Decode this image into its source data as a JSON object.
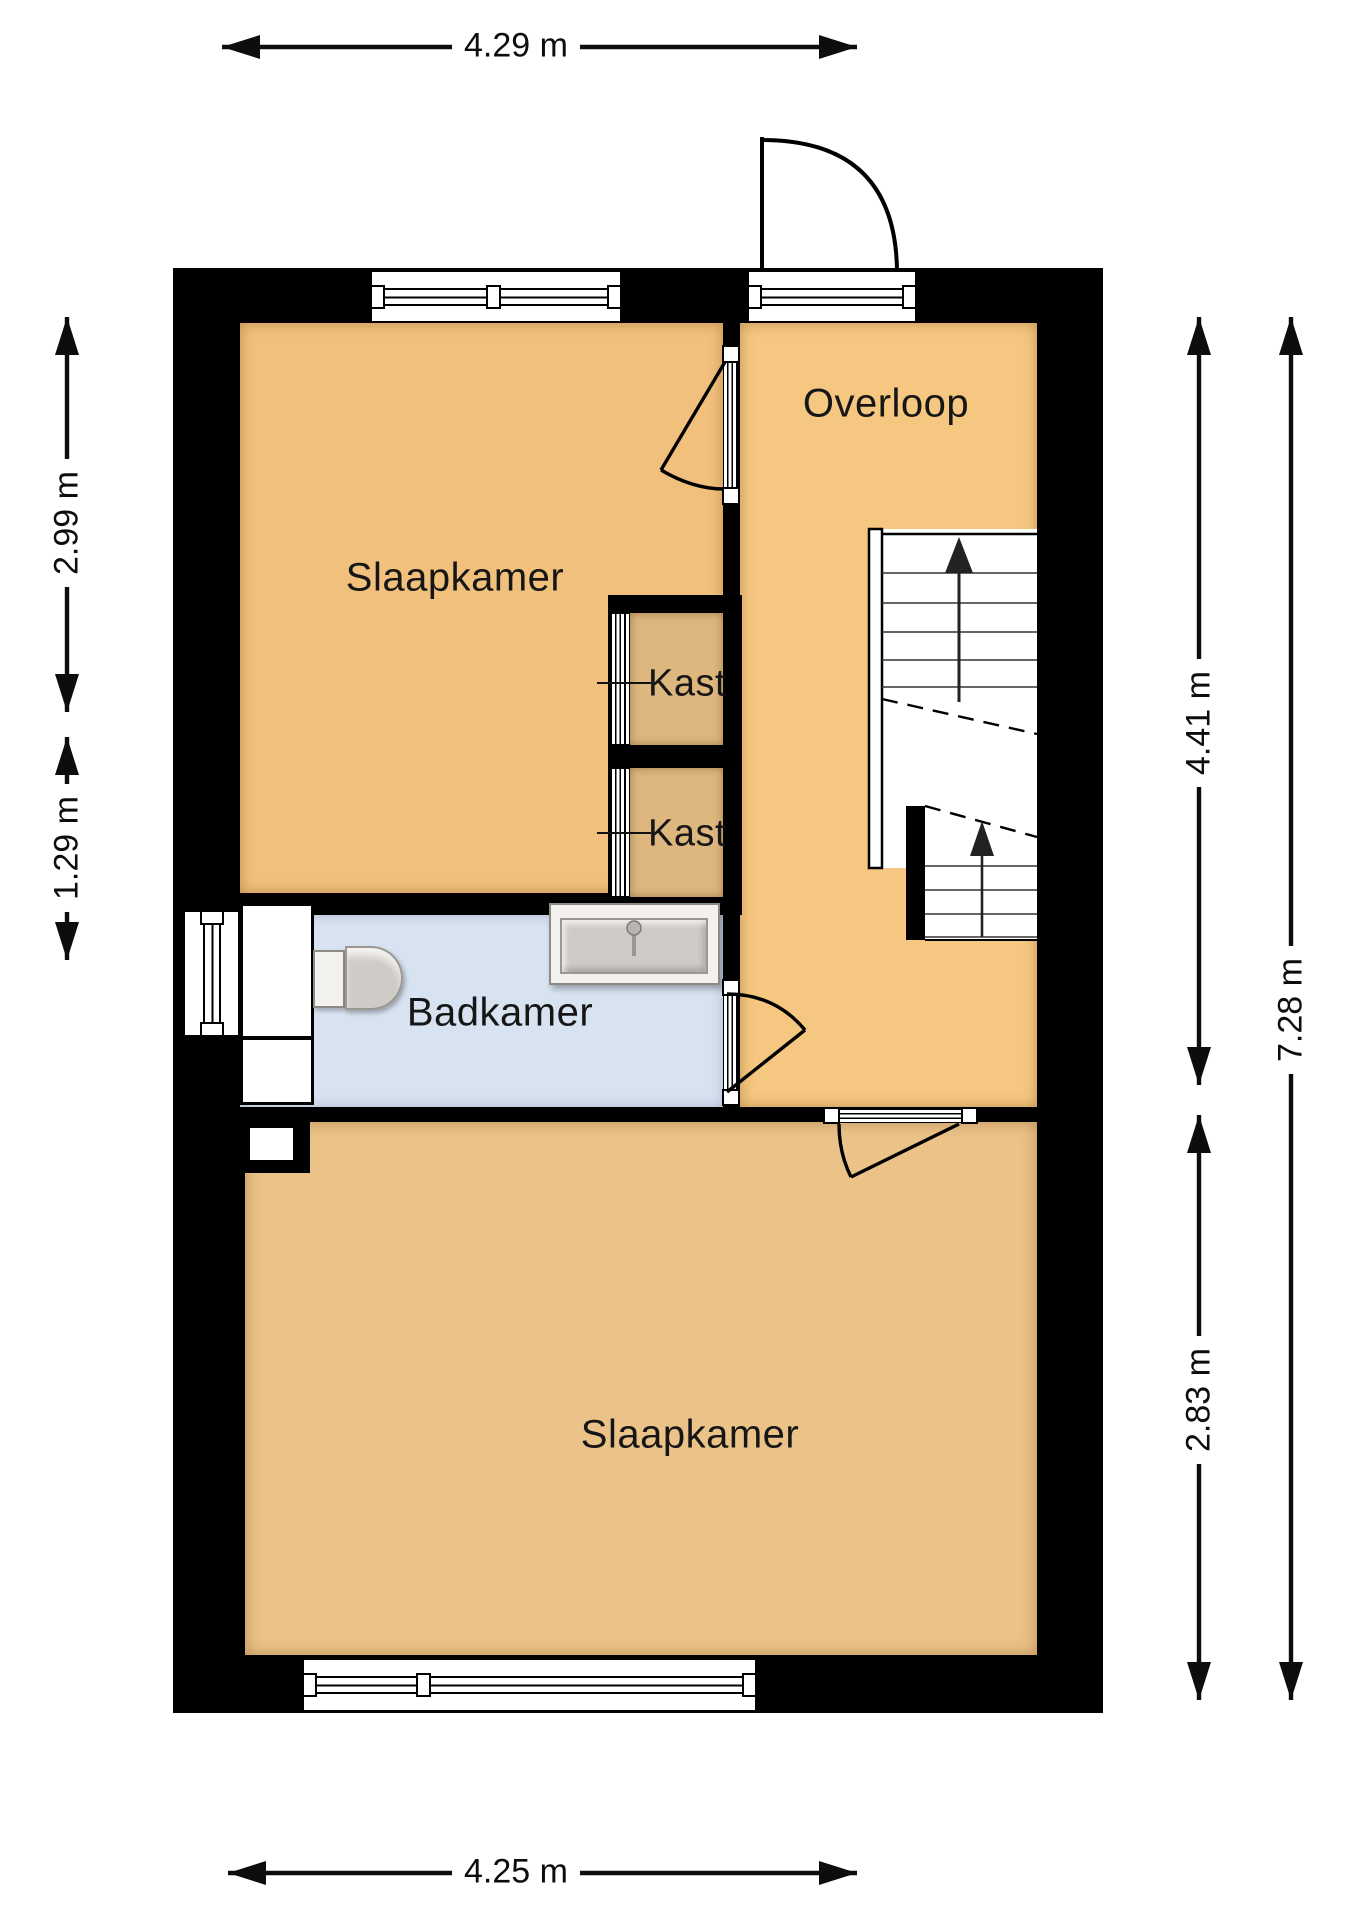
{
  "title": "Floor plan - first floor (verdieping)",
  "rooms": {
    "slaapkamer_1": {
      "label": "Slaapkamer"
    },
    "overloop": {
      "label": "Overloop"
    },
    "kast_1": {
      "label": "Kast"
    },
    "kast_2": {
      "label": "Kast"
    },
    "badkamer": {
      "label": "Badkamer"
    },
    "slaapkamer_2": {
      "label": "Slaapkamer"
    }
  },
  "dimensions": {
    "top": "4.29 m",
    "bottom": "4.25 m",
    "left_upper": "2.99 m",
    "left_lower": "1.29 m",
    "right_upper": "4.41 m",
    "right_lower": "2.83 m",
    "right_total": "7.28 m"
  },
  "colors": {
    "wall": "#000000",
    "bedroom": "#F0C07C",
    "landing": "#F5C781",
    "closet": "#DDB77E",
    "bathroom": "#D8E3F1",
    "bedroom2": "#EBC389",
    "stairs": "#FFFFFF",
    "fixture_light": "#F3F1EE",
    "fixture_dark": "#CFCBC7",
    "line": "#111111"
  }
}
